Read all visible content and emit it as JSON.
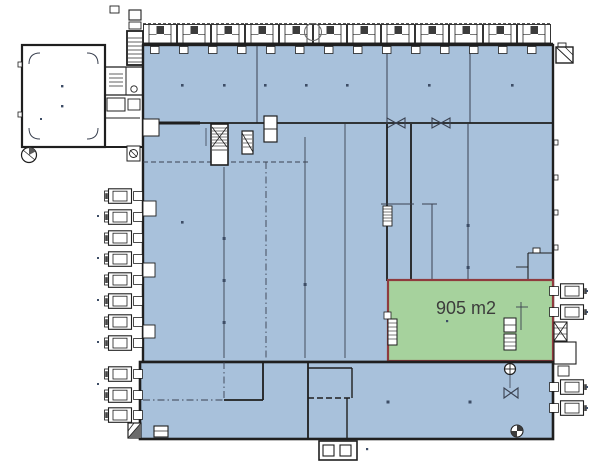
{
  "plan": {
    "highlighted_unit": {
      "area_label": "905 m2"
    }
  },
  "colors": {
    "bg": "#ffffff",
    "hall-fill": "#a8c1db",
    "wall": "#1f1f1f",
    "line": "#3a4150",
    "dot": "#3d4d66",
    "unit-fill": "#a6d29d",
    "unit-stroke": "#8f3b3e",
    "label-text": "#3c3c3c"
  }
}
